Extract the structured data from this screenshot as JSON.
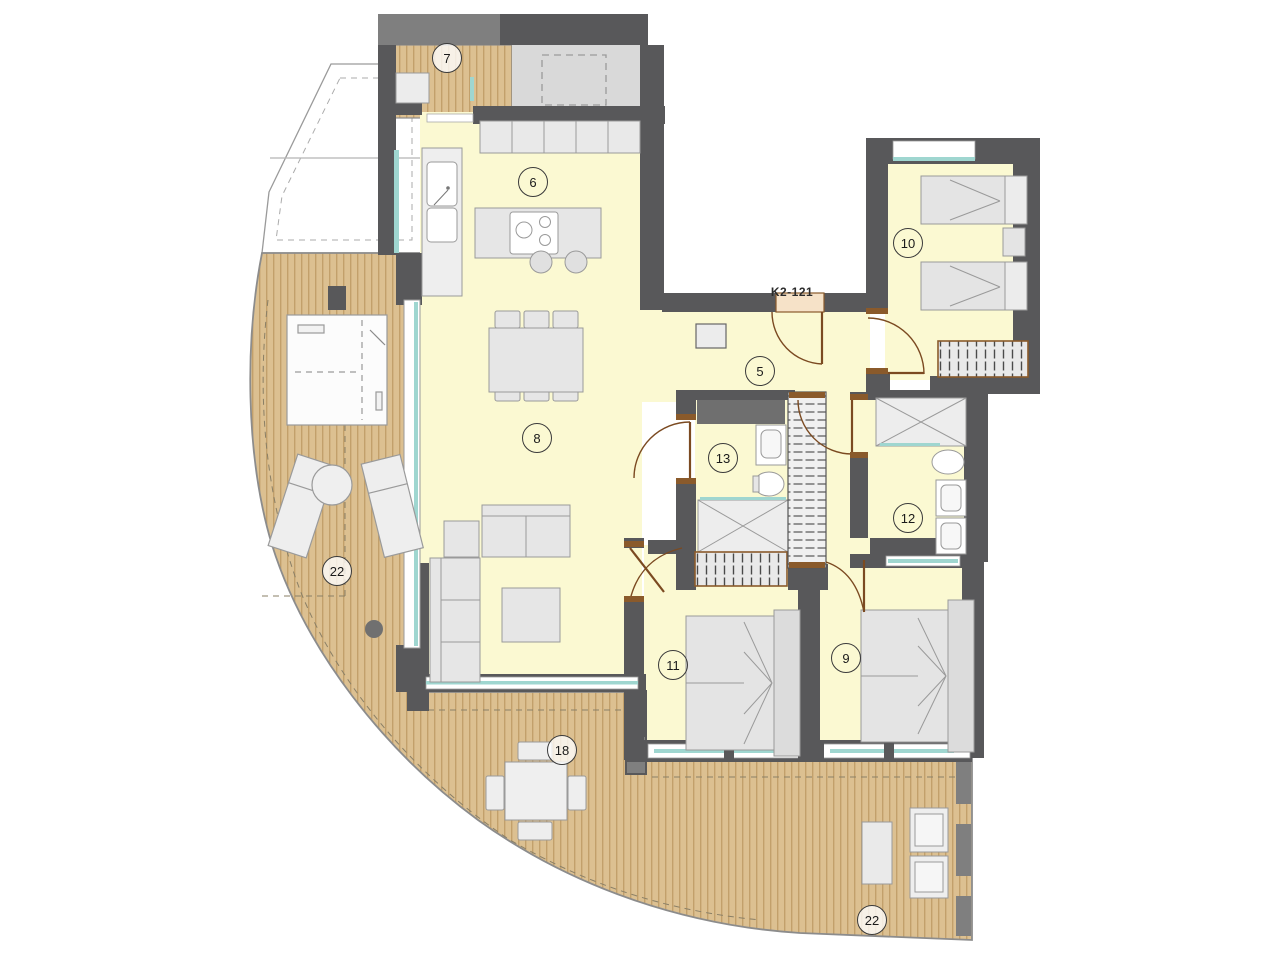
{
  "unit_label": "K2-121",
  "rooms": {
    "balcony7": {
      "number": "7"
    },
    "kitchen": {
      "number": "6"
    },
    "bedroom10": {
      "number": "10"
    },
    "hall": {
      "number": "5"
    },
    "living": {
      "number": "8"
    },
    "bath13": {
      "number": "13"
    },
    "bath12": {
      "number": "12"
    },
    "terraceLeft": {
      "number": "22"
    },
    "bedroom11": {
      "number": "11"
    },
    "bedroom9": {
      "number": "9"
    },
    "terraceBottom": {
      "number": "18"
    },
    "terraceRight": {
      "number": "22"
    }
  },
  "colors": {
    "wall": "#58585a",
    "wall_light": "#7f7f7f",
    "room_fill": "#fbf9d2",
    "deck_fill": "#dcc091",
    "deck_stripe": "#c2a06b",
    "glazing": "#9fd6d0",
    "door_frame": "#8a5a2b",
    "furniture_fill": "#e6e6e6",
    "furniture_stroke": "#9a9a9a"
  }
}
